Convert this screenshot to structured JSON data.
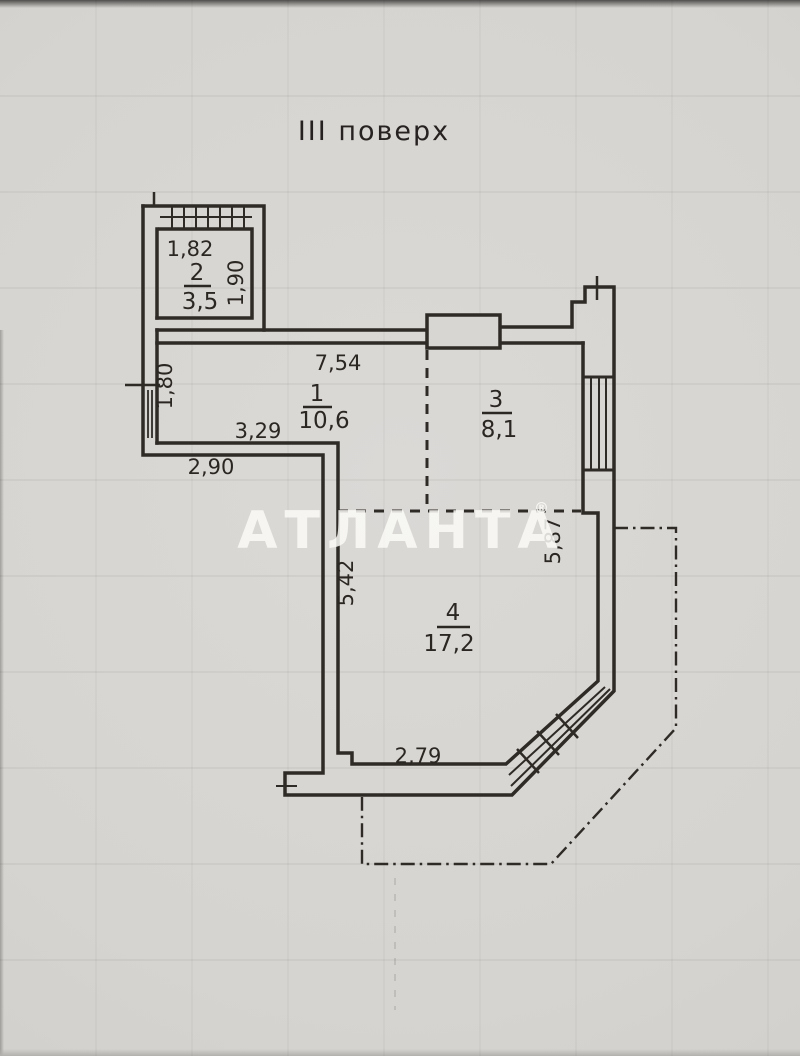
{
  "title": "ІІІ поверх",
  "watermark": {
    "text": "АТЛАНТА",
    "registered": "®"
  },
  "rooms": {
    "room1": {
      "number": "1",
      "area": "10,6"
    },
    "room2": {
      "number": "2",
      "area": "3,5"
    },
    "room3": {
      "number": "3",
      "area": "8,1"
    },
    "room4": {
      "number": "4",
      "area": "17,2"
    }
  },
  "dimensions": {
    "room2_width": "1,82",
    "room2_depth": "1,90",
    "hall_top": "7,54",
    "hall_left_window": "1,80",
    "hall_inner": "3,29",
    "hall_bottom": "2,90",
    "room4_left": "5,42",
    "room4_right": "5,87",
    "room4_bottom": "2,79"
  },
  "colors": {
    "paper": "#d8d6d2",
    "ink": "#2e2b27",
    "watermark": "#f5f4f2"
  }
}
